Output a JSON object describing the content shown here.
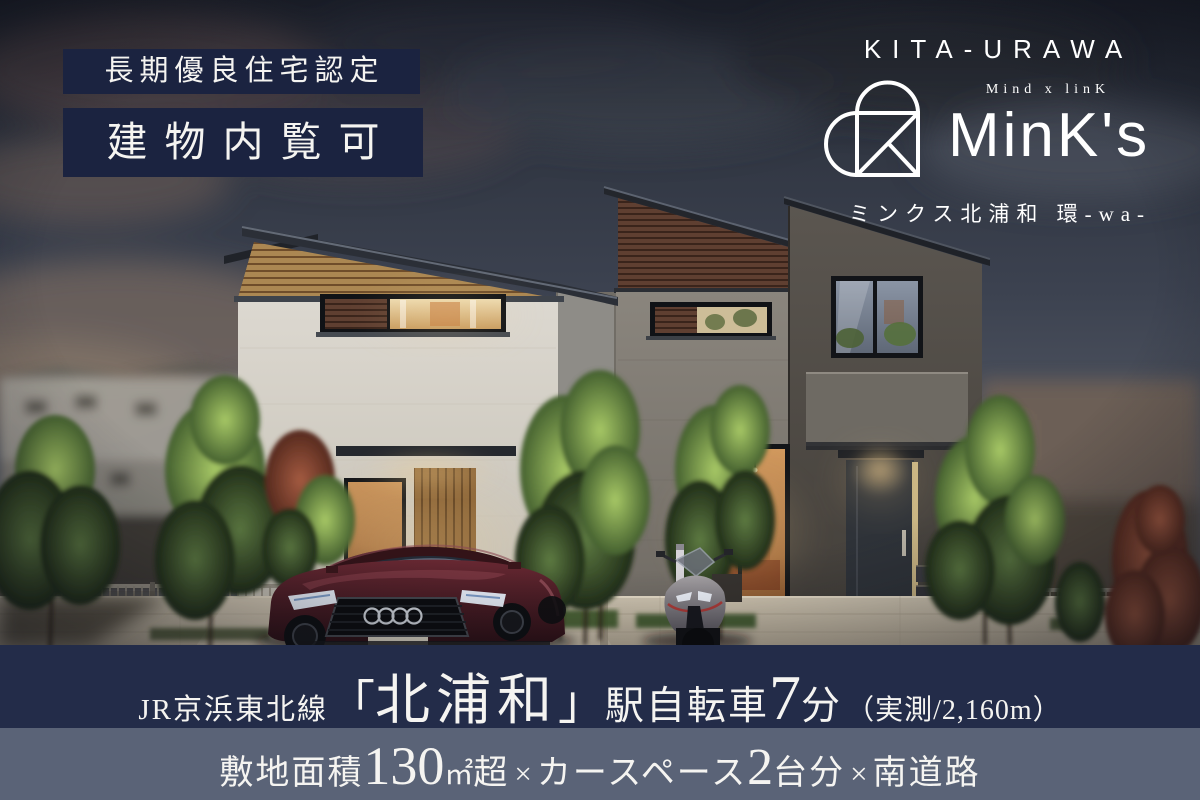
{
  "badges": {
    "certification": "長期優良住宅認定",
    "viewing": "建物内覧可"
  },
  "logo": {
    "area": "KITA-URAWA",
    "tagline": "Mind x linK",
    "brand": "MinK's",
    "name_ja": "ミンクス北浦和 環-wa-"
  },
  "access_bar": {
    "line": "JR京浜東北線",
    "bracket_open": "「",
    "station": "北浦和",
    "bracket_close": "」",
    "mode": "駅自転車",
    "minutes": "7",
    "minutes_unit": "分",
    "note": "（実測/2,160m）"
  },
  "feature_bar": {
    "land_label": "敷地面積",
    "land_value": "130",
    "land_unit": "㎡",
    "land_suffix": "超",
    "x1": "×",
    "car_label": "カースペース",
    "car_value": "2",
    "car_unit": "台分",
    "x2": "×",
    "road": "南道路"
  },
  "colors": {
    "badge_navy": "#1b2340",
    "access_bar_navy": "#232c49",
    "feature_bar_slate": "#5a6377",
    "text_white": "#f5f4f1"
  }
}
